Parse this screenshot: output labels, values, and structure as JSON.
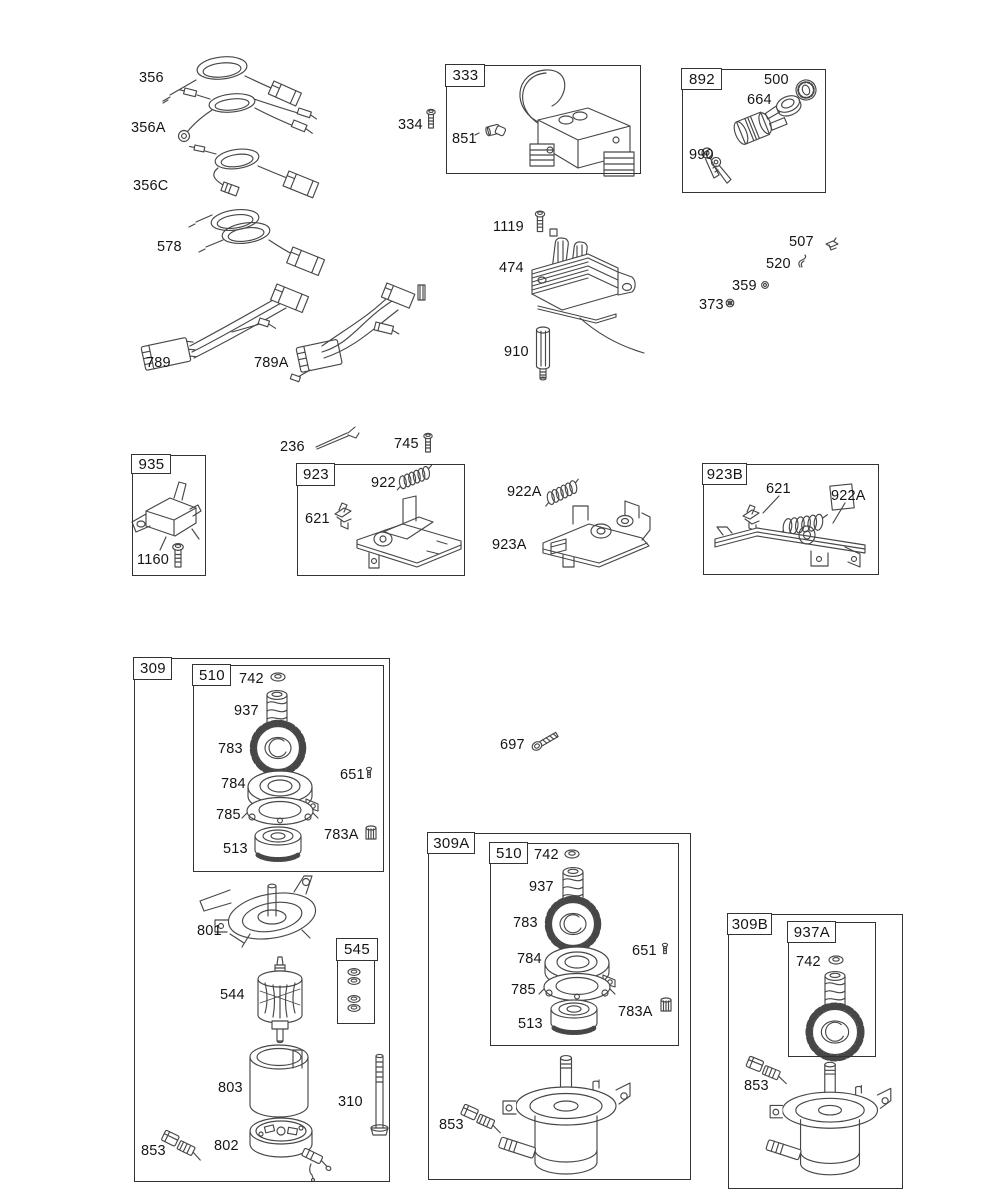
{
  "diagram": {
    "title": "Engine electrical and starter motor exploded parts diagram",
    "colors": {
      "background": "#ffffff",
      "line": "#333333",
      "ink": "#474747",
      "text": "#151515"
    }
  },
  "part_labels": [
    {
      "id": "356",
      "text": "356",
      "x": 139,
      "y": 70
    },
    {
      "id": "356A",
      "text": "356A",
      "x": 131,
      "y": 120
    },
    {
      "id": "356C",
      "text": "356C",
      "x": 133,
      "y": 178
    },
    {
      "id": "578",
      "text": "578",
      "x": 157,
      "y": 239
    },
    {
      "id": "334",
      "text": "334",
      "x": 398,
      "y": 117
    },
    {
      "id": "851",
      "text": "851",
      "x": 452,
      "y": 131
    },
    {
      "id": "500",
      "text": "500",
      "x": 764,
      "y": 72
    },
    {
      "id": "664",
      "text": "664",
      "x": 747,
      "y": 92
    },
    {
      "id": "990",
      "text": "990",
      "x": 689,
      "y": 147
    },
    {
      "id": "1119",
      "text": "1119",
      "x": 493,
      "y": 219
    },
    {
      "id": "474",
      "text": "474",
      "x": 499,
      "y": 260
    },
    {
      "id": "910",
      "text": "910",
      "x": 504,
      "y": 344
    },
    {
      "id": "507",
      "text": "507",
      "x": 789,
      "y": 234
    },
    {
      "id": "520",
      "text": "520",
      "x": 766,
      "y": 256
    },
    {
      "id": "359",
      "text": "359",
      "x": 732,
      "y": 278
    },
    {
      "id": "373",
      "text": "373",
      "x": 699,
      "y": 297
    },
    {
      "id": "789",
      "text": "789",
      "x": 146,
      "y": 355
    },
    {
      "id": "789A",
      "text": "789A",
      "x": 254,
      "y": 355
    },
    {
      "id": "236",
      "text": "236",
      "x": 280,
      "y": 439
    },
    {
      "id": "745",
      "text": "745",
      "x": 394,
      "y": 436
    },
    {
      "id": "1160",
      "text": "1160",
      "x": 137,
      "y": 552
    },
    {
      "id": "922",
      "text": "922",
      "x": 371,
      "y": 475
    },
    {
      "id": "621-923",
      "text": "621",
      "x": 305,
      "y": 511
    },
    {
      "id": "922A-mid",
      "text": "922A",
      "x": 507,
      "y": 484
    },
    {
      "id": "923A",
      "text": "923A",
      "x": 492,
      "y": 537
    },
    {
      "id": "621-923B",
      "text": "621",
      "x": 766,
      "y": 481
    },
    {
      "id": "922A-923B",
      "text": "922A",
      "x": 831,
      "y": 488
    },
    {
      "id": "697",
      "text": "697",
      "x": 500,
      "y": 737
    },
    {
      "id": "742-309",
      "text": "742",
      "x": 239,
      "y": 671
    },
    {
      "id": "937-309",
      "text": "937",
      "x": 234,
      "y": 703
    },
    {
      "id": "783-309",
      "text": "783",
      "x": 218,
      "y": 741
    },
    {
      "id": "784-309",
      "text": "784",
      "x": 221,
      "y": 776
    },
    {
      "id": "785-309",
      "text": "785",
      "x": 216,
      "y": 807
    },
    {
      "id": "513-309",
      "text": "513",
      "x": 223,
      "y": 841
    },
    {
      "id": "651-309",
      "text": "651",
      "x": 340,
      "y": 767
    },
    {
      "id": "783A-309",
      "text": "783A",
      "x": 324,
      "y": 827
    },
    {
      "id": "801",
      "text": "801",
      "x": 197,
      "y": 923
    },
    {
      "id": "544",
      "text": "544",
      "x": 220,
      "y": 987
    },
    {
      "id": "803",
      "text": "803",
      "x": 218,
      "y": 1080
    },
    {
      "id": "310",
      "text": "310",
      "x": 338,
      "y": 1094
    },
    {
      "id": "802",
      "text": "802",
      "x": 214,
      "y": 1138
    },
    {
      "id": "853-309",
      "text": "853",
      "x": 141,
      "y": 1143
    },
    {
      "id": "742-309A",
      "text": "742",
      "x": 534,
      "y": 847
    },
    {
      "id": "937-309A",
      "text": "937",
      "x": 529,
      "y": 879
    },
    {
      "id": "783-309A",
      "text": "783",
      "x": 513,
      "y": 915
    },
    {
      "id": "784-309A",
      "text": "784",
      "x": 517,
      "y": 951
    },
    {
      "id": "785-309A",
      "text": "785",
      "x": 511,
      "y": 982
    },
    {
      "id": "513-309A",
      "text": "513",
      "x": 518,
      "y": 1016
    },
    {
      "id": "651-309A",
      "text": "651",
      "x": 632,
      "y": 943
    },
    {
      "id": "783A-309A",
      "text": "783A",
      "x": 618,
      "y": 1004
    },
    {
      "id": "853-309A",
      "text": "853",
      "x": 439,
      "y": 1117
    },
    {
      "id": "742-309B",
      "text": "742",
      "x": 796,
      "y": 954
    },
    {
      "id": "853-309B",
      "text": "853",
      "x": 744,
      "y": 1078
    }
  ],
  "group_boxes": [
    {
      "id": "333",
      "label": "333",
      "x": 446,
      "y": 65,
      "w": 193,
      "h": 107,
      "tw": 38,
      "th": 21
    },
    {
      "id": "892",
      "label": "892",
      "x": 682,
      "y": 69,
      "w": 142,
      "h": 122,
      "tw": 39,
      "th": 20
    },
    {
      "id": "935",
      "label": "935",
      "x": 132,
      "y": 455,
      "w": 72,
      "h": 119,
      "tw": 38,
      "th": 18
    },
    {
      "id": "923",
      "label": "923",
      "x": 297,
      "y": 464,
      "w": 166,
      "h": 110,
      "tw": 37,
      "th": 21
    },
    {
      "id": "923B",
      "label": "923B",
      "x": 703,
      "y": 464,
      "w": 174,
      "h": 109,
      "tw": 43,
      "th": 20
    },
    {
      "id": "309",
      "label": "309",
      "x": 134,
      "y": 658,
      "w": 254,
      "h": 522,
      "tw": 37,
      "th": 21
    },
    {
      "id": "510-309",
      "label": "510",
      "x": 193,
      "y": 665,
      "w": 189,
      "h": 205,
      "tw": 37,
      "th": 20
    },
    {
      "id": "545",
      "label": "545",
      "x": 337,
      "y": 939,
      "w": 36,
      "h": 83,
      "tw": 36,
      "th": 21,
      "header": true
    },
    {
      "id": "309A",
      "label": "309A",
      "x": 428,
      "y": 833,
      "w": 261,
      "h": 345,
      "tw": 46,
      "th": 20
    },
    {
      "id": "510-309A",
      "label": "510",
      "x": 490,
      "y": 843,
      "w": 187,
      "h": 201,
      "tw": 37,
      "th": 20
    },
    {
      "id": "309B",
      "label": "309B",
      "x": 728,
      "y": 914,
      "w": 173,
      "h": 273,
      "tw": 43,
      "th": 20
    },
    {
      "id": "937A",
      "label": "937A",
      "x": 788,
      "y": 922,
      "w": 86,
      "h": 133,
      "tw": 47,
      "th": 20
    }
  ]
}
